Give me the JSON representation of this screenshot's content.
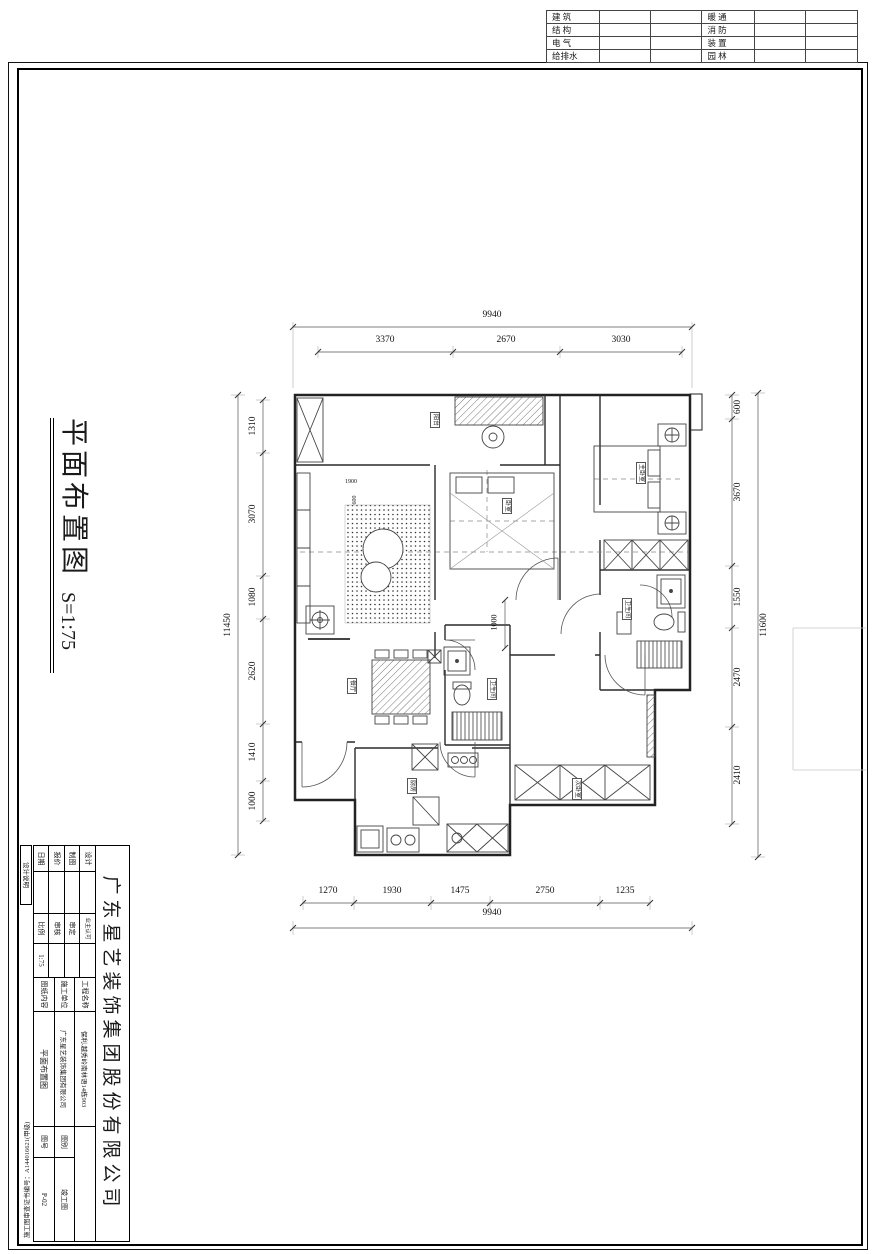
{
  "sheet": {
    "top_table": {
      "rows": [
        [
          "建 筑",
          "暖 通"
        ],
        [
          "结 构",
          "消 防"
        ],
        [
          "电 气",
          "装 置"
        ],
        [
          "给排水",
          "园 林"
        ]
      ]
    },
    "side_title": {
      "text": "平面布置图",
      "scale": "S=1:75"
    },
    "left_strip": {
      "label": "设计说明",
      "cert": "施工图审查证书编号：A144016621(甲级)"
    },
    "title_block": {
      "company": "广东星艺装饰集团股份有限公司",
      "fields_left": [
        {
          "label": "设计"
        },
        {
          "label": "制图"
        },
        {
          "label": "报价"
        },
        {
          "label": "日期"
        }
      ],
      "fields_mid": [
        {
          "label": "业主认可",
          "value": ""
        },
        {
          "label": "审定",
          "value": ""
        },
        {
          "label": "审核",
          "value": ""
        },
        {
          "label": "比例",
          "value": "1:75"
        }
      ],
      "fields_info": [
        {
          "label": "工程名称",
          "value": "保利.越秀岭南林语14栋903"
        },
        {
          "label": "施工单位",
          "value": "广东星艺装饰集团有限公司"
        },
        {
          "label": "图纸内容",
          "value": "平面布置图"
        }
      ],
      "fields_meta": [
        {
          "label": "图别",
          "value": "竣工图"
        },
        {
          "label": "图号",
          "value": "P-02"
        }
      ]
    }
  },
  "plan": {
    "dims": {
      "top_total": "9940",
      "top": [
        "3370",
        "2670",
        "3030"
      ],
      "bottom": [
        "1270",
        "1930",
        "1475",
        "2750",
        "1235"
      ],
      "bottom_total": "9940",
      "left": [
        "1310",
        "3070",
        "1080",
        "2620",
        "1410",
        "1000"
      ],
      "left_total": "11450",
      "right": [
        "600",
        "3670",
        "1550",
        "2470",
        "2410"
      ],
      "right_total": "11600",
      "inner": [
        "1000",
        "1900",
        "600"
      ]
    },
    "rooms": [
      "阳台",
      "卧室",
      "主卧室",
      "卫生间",
      "餐厅",
      "卫生间",
      "厨房",
      "次卧室"
    ]
  }
}
